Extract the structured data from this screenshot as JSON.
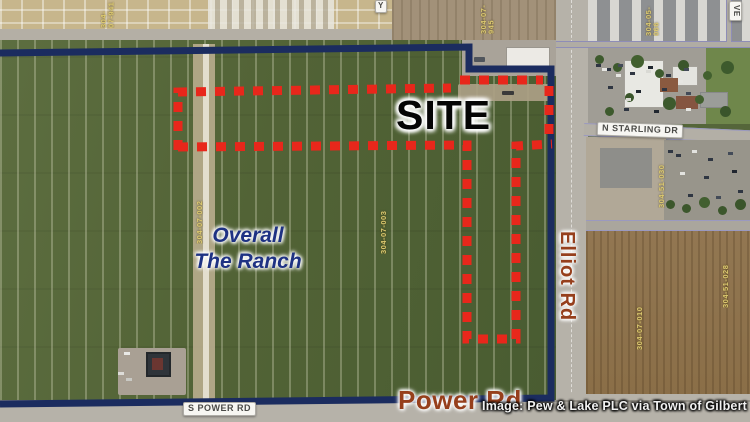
{
  "annotations": {
    "site_label": "SITE",
    "overall_line1": "Overall",
    "overall_line2": "The Ranch",
    "credit": "Image: Pew & Lake PLC via Town of Gilbert"
  },
  "roads": {
    "power_rd_big": "Power Rd",
    "elliot_rd_big": "Elliot Rd",
    "s_power_rd_pill": "S POWER RD",
    "n_starling_dr_pill": "N STARLING DR",
    "ve_pill_partial": "VE",
    "y_pill_partial": "Y"
  },
  "parcel_labels": [
    {
      "text": "304-07-002"
    },
    {
      "text": "304-07-003"
    },
    {
      "text": "304-07-945"
    },
    {
      "text": "304-07-941"
    },
    {
      "text": "304-05-066"
    },
    {
      "text": "304-51-030"
    },
    {
      "text": "304-07-010"
    },
    {
      "text": "304-51-028"
    }
  ],
  "colors": {
    "boundary_navy": "#1b2c5f",
    "site_dash_red": "#e8271b",
    "road_label_brown": "#963f1c",
    "ranch_label_blue": "#1e3283",
    "field_green": "#526336",
    "field_brown": "#8a6e47"
  }
}
